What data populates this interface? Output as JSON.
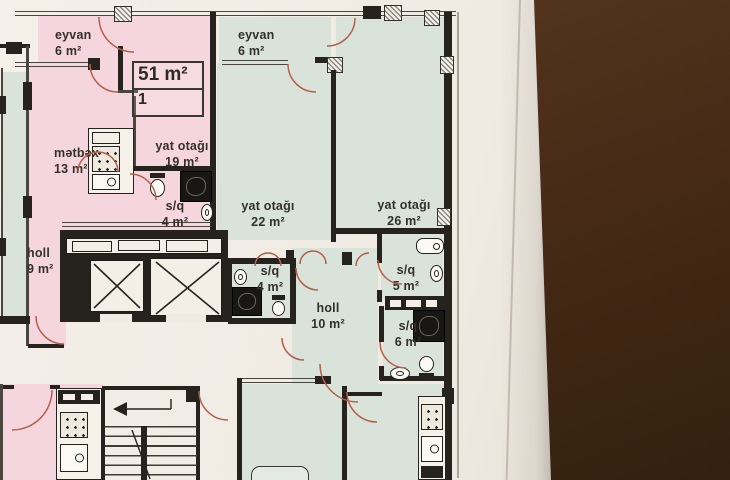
{
  "floor_plan": {
    "unit_card": {
      "area": "51 m²",
      "number": "1"
    },
    "rooms": {
      "eyvan_left": {
        "name": "eyvan",
        "area": "6 m²"
      },
      "metbex": {
        "name": "mətbəx",
        "area": "13 m²"
      },
      "yat19": {
        "name": "yat otağı",
        "area": "19 m²"
      },
      "sq4_left": {
        "name": "s/q",
        "area": "4 m²"
      },
      "holl9": {
        "name": "holl",
        "area": "9 m²"
      },
      "eyvan_right": {
        "name": "eyvan",
        "area": "6 m²"
      },
      "yat22": {
        "name": "yat otağı",
        "area": "22 m²"
      },
      "yat26": {
        "name": "yat otağı",
        "area": "26 m²"
      },
      "sq4_mid": {
        "name": "s/q",
        "area": "4 m²"
      },
      "holl10": {
        "name": "holl",
        "area": "10 m²"
      },
      "sq5": {
        "name": "s/q",
        "area": "5 m²"
      },
      "sq6": {
        "name": "s/q",
        "area": "6 m²"
      }
    },
    "colors": {
      "pink_room": "#f6d6de",
      "green_room": "#d9e3da",
      "wall": "#26231e",
      "door_arc": "#b4604a",
      "paper": "#efeae2",
      "backdrop": "#4b2d18",
      "label_text": "#33302a"
    }
  }
}
